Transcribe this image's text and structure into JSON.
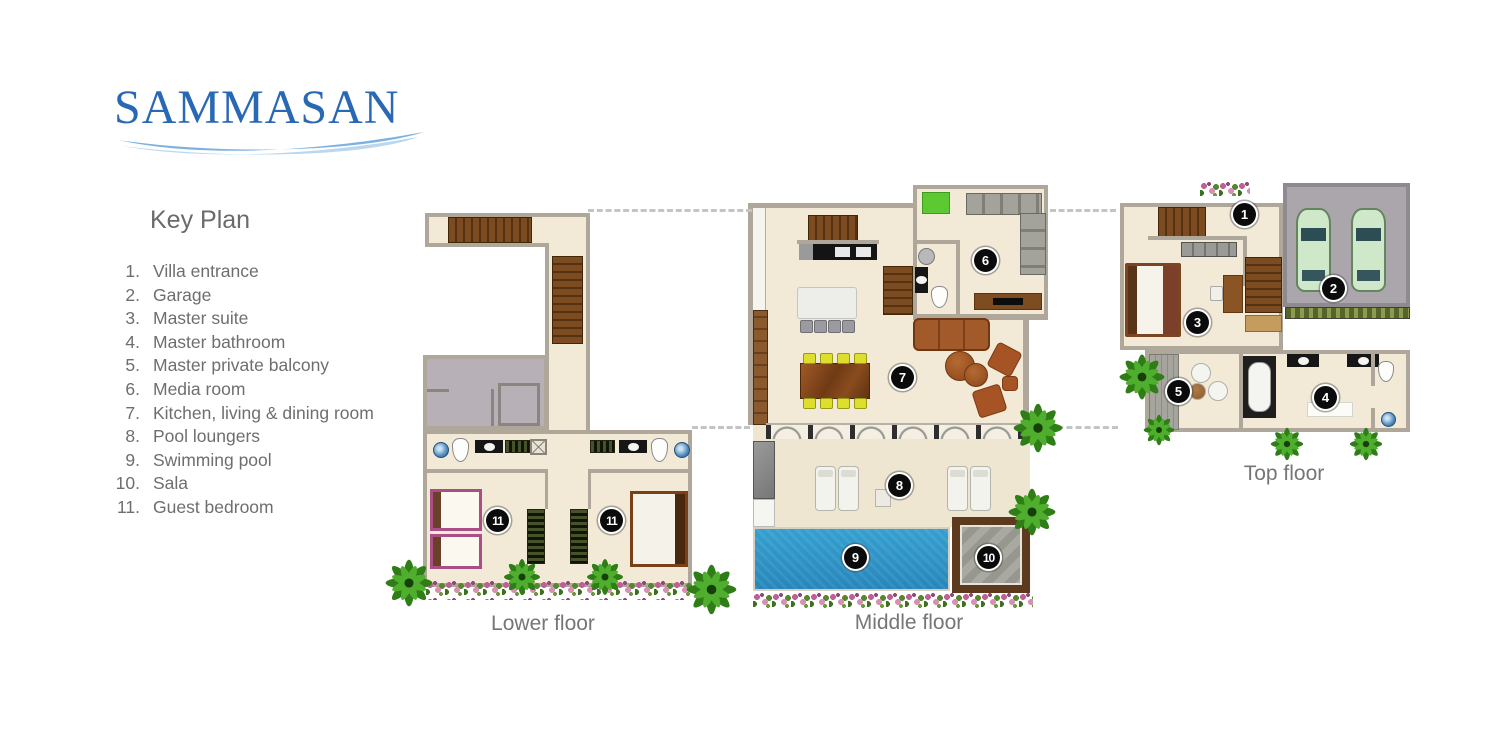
{
  "brand": {
    "name": "SAMMASAN"
  },
  "key_plan": {
    "title": "Key Plan",
    "items": [
      {
        "num": "1.",
        "label": "Villa entrance"
      },
      {
        "num": "2.",
        "label": "Garage"
      },
      {
        "num": "3.",
        "label": "Master suite"
      },
      {
        "num": "4.",
        "label": "Master bathroom"
      },
      {
        "num": "5.",
        "label": "Master private balcony"
      },
      {
        "num": "6.",
        "label": "Media room"
      },
      {
        "num": "7.",
        "label": "Kitchen, living & dining room"
      },
      {
        "num": "8.",
        "label": "Pool loungers"
      },
      {
        "num": "9.",
        "label": "Swimming pool"
      },
      {
        "num": "10.",
        "label": "Sala"
      },
      {
        "num": "11.",
        "label": "Guest bedroom"
      }
    ]
  },
  "floors": {
    "lower": {
      "label": "Lower floor",
      "markers": [
        "11",
        "11"
      ]
    },
    "middle": {
      "label": "Middle floor",
      "markers": [
        "6",
        "7",
        "8",
        "9",
        "10"
      ]
    },
    "top": {
      "label": "Top floor",
      "markers": [
        "1",
        "2",
        "3",
        "4",
        "5"
      ]
    }
  },
  "colors": {
    "logo_blue": "#2968b4",
    "wave_blue": "#7db2e0",
    "wave_light": "#b9d7ef",
    "pool_blue": "#2e95c5",
    "floor_cream": "#f2e9d6",
    "wall_gray": "#aea79a",
    "stair_brown": "#7d4b22",
    "marker_black": "#0b0b0b",
    "text_gray": "#6e6e6e",
    "sala_wood": "#5d3a1e",
    "media_mat_green": "#5cc832",
    "garage_gray": "#aba5ac"
  }
}
